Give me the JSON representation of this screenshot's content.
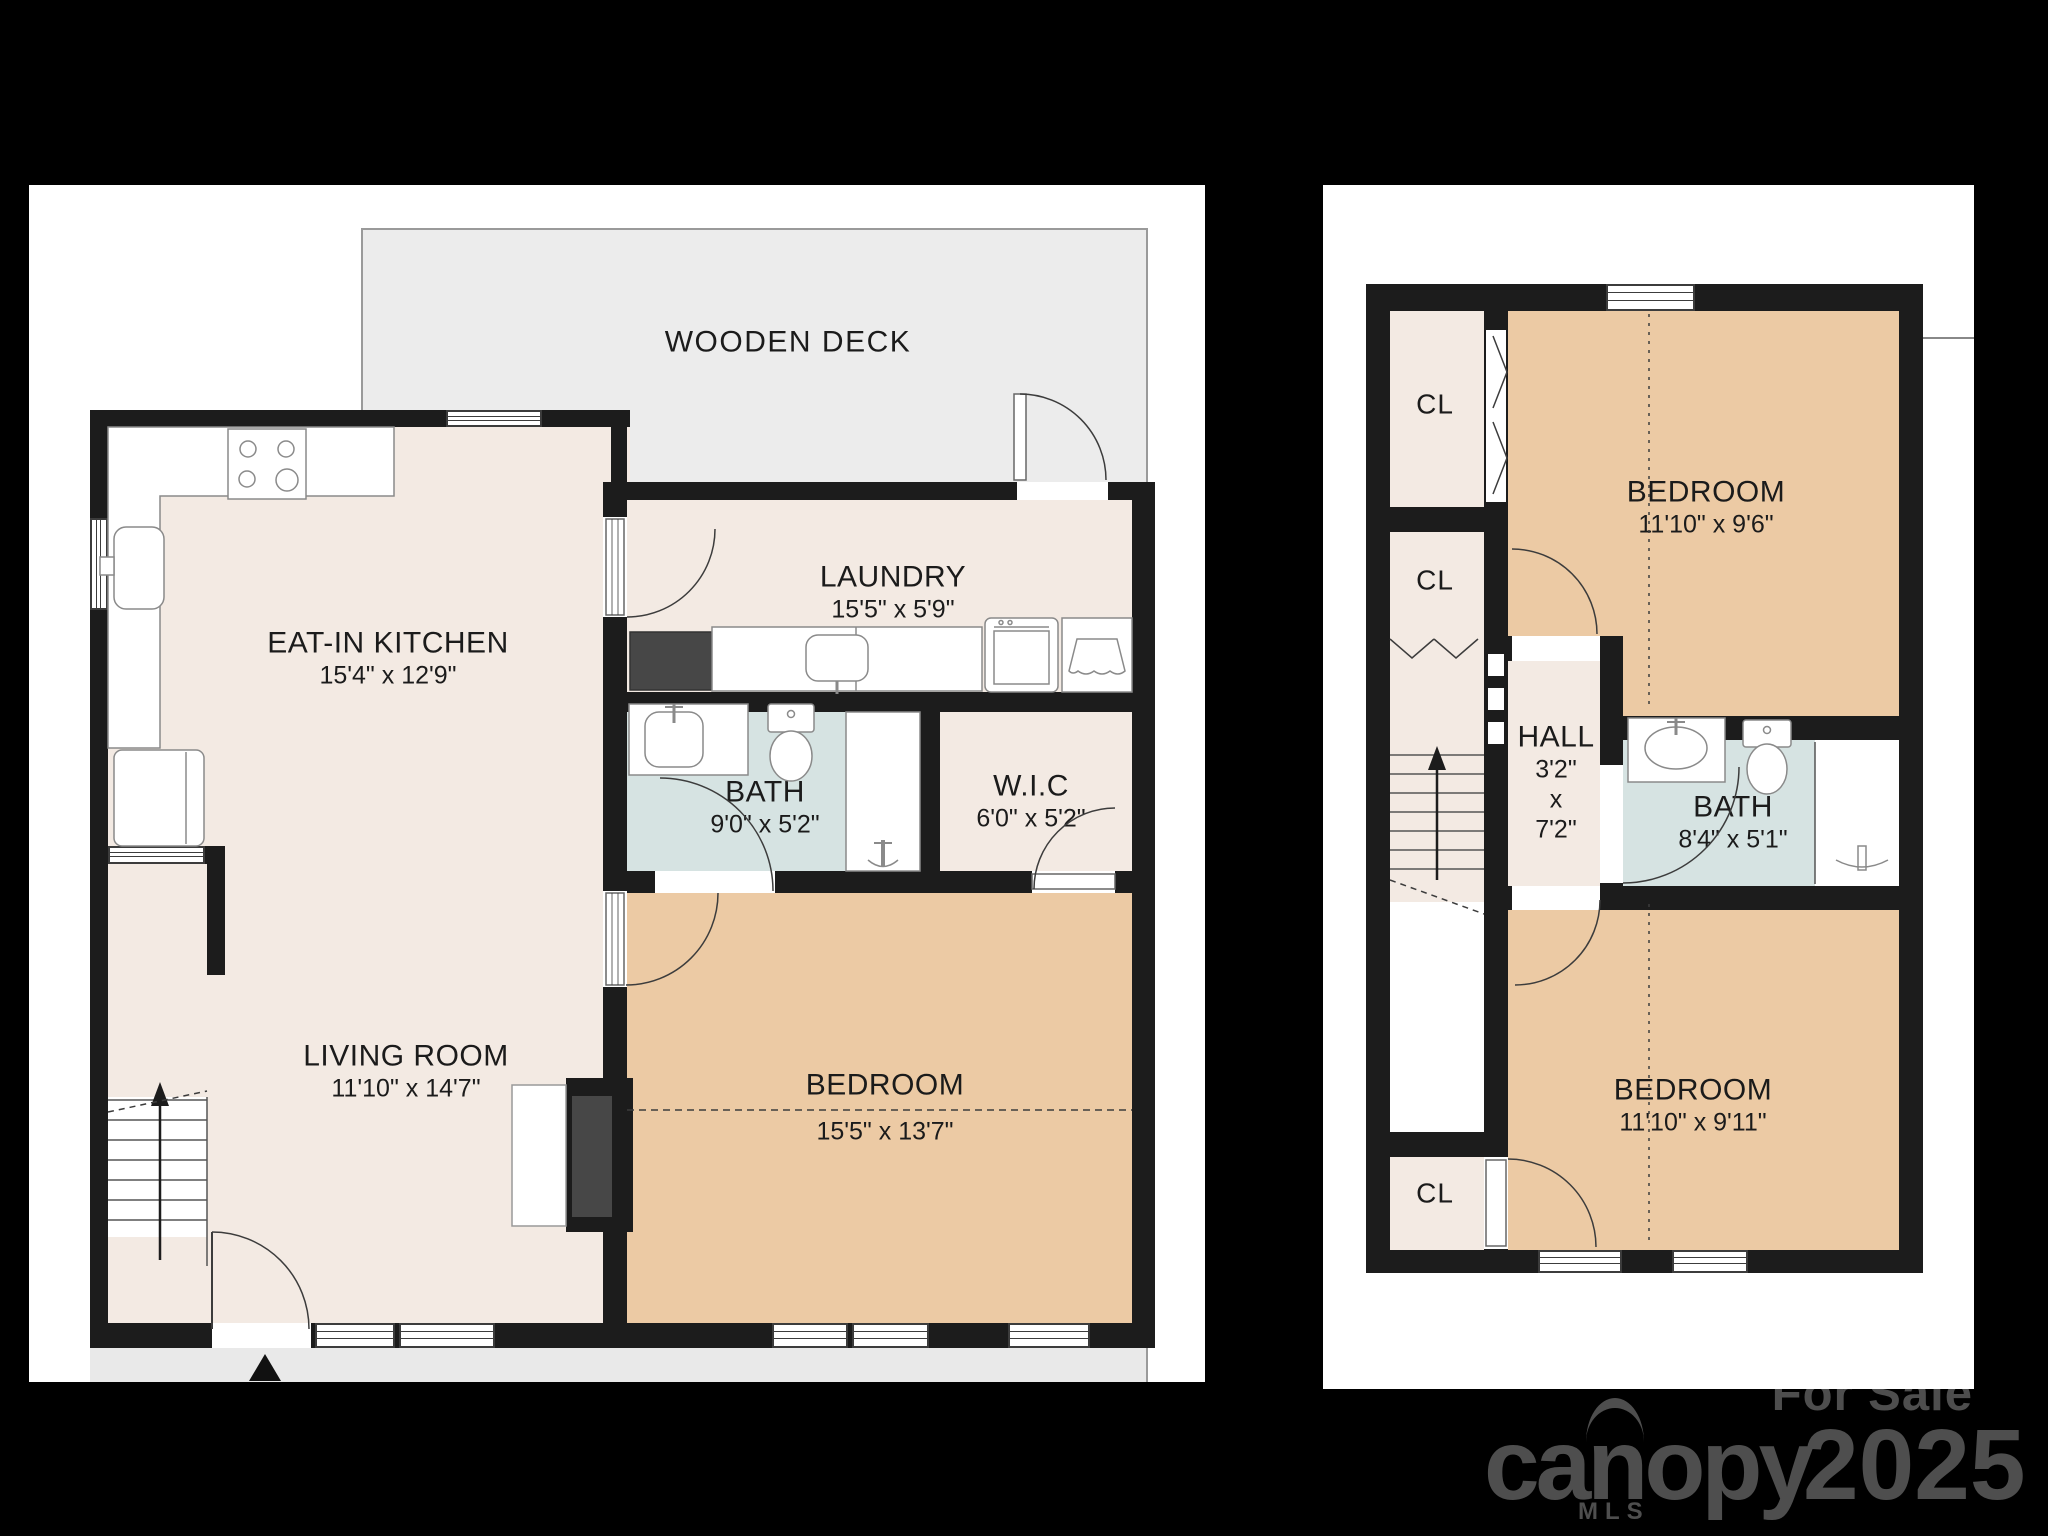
{
  "colors": {
    "background": "#000000",
    "wall": "#1c1c1c",
    "floor_beige": "#f3eae3",
    "bedroom_tan": "#eccaa4",
    "bath_blue": "#d6e3e2",
    "deck_gray": "#ececec",
    "porch_gray": "#e9e9e9",
    "fixture_dark": "#474747",
    "watermark_gray": "#4e4e4e"
  },
  "floor1": {
    "deck": {
      "label": "WOODEN DECK"
    },
    "kitchen": {
      "name": "EAT-IN KITCHEN",
      "dims": "15'4\" x 12'9\""
    },
    "laundry": {
      "name": "LAUNDRY",
      "dims": "15'5\" x 5'9\""
    },
    "bath": {
      "name": "BATH",
      "dims": "9'0\" x 5'2\""
    },
    "wic": {
      "name": "W.I.C",
      "dims": "6'0\" x 5'2\""
    },
    "living": {
      "name": "LIVING ROOM",
      "dims": "11'10\" x 14'7\""
    },
    "bedroom": {
      "name": "BEDROOM",
      "dims": "15'5\" x 13'7\""
    }
  },
  "floor2": {
    "closet_label": "CL",
    "bedroom_top": {
      "name": "BEDROOM",
      "dims": "11'10\" x 9'6\""
    },
    "hall": {
      "name": "HALL",
      "dim1": "3'2\"",
      "dim2": "x",
      "dim3": "7'2\""
    },
    "bath": {
      "name": "BATH",
      "dims": "8'4\" x 5'1\""
    },
    "bedroom_bottom": {
      "name": "BEDROOM",
      "dims": "11'10\" x 9'11\""
    }
  },
  "watermark": {
    "for_sale": "For Sale",
    "brand": "canopy",
    "brand_sub": "MLS",
    "year": "2025"
  }
}
